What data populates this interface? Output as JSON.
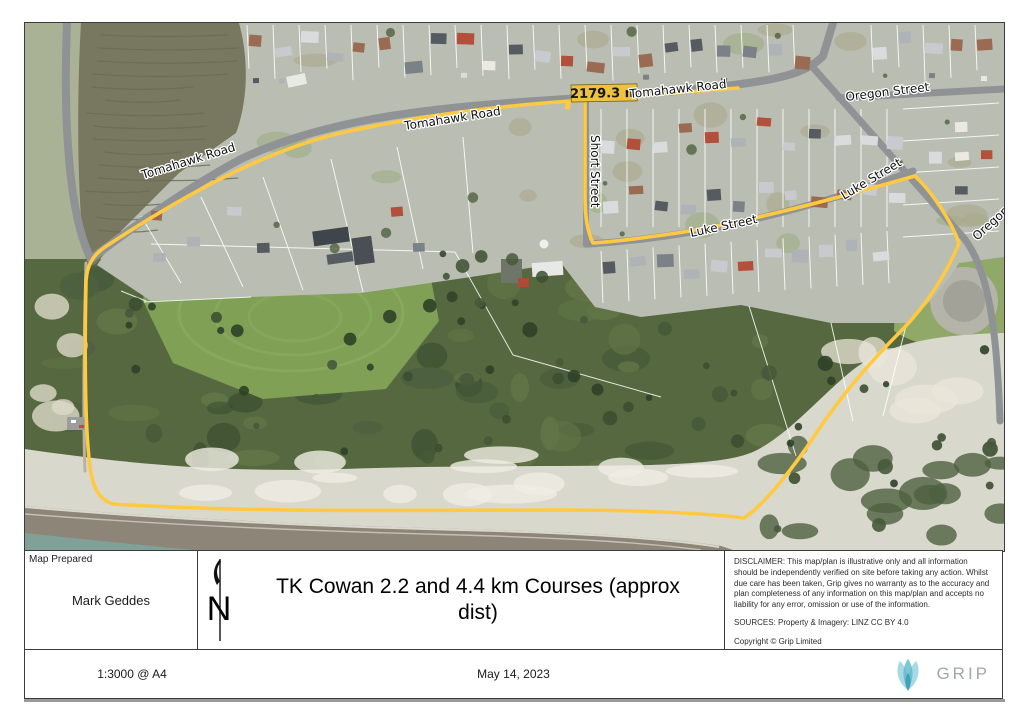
{
  "map": {
    "distance_label": "2179.3 m",
    "streets": {
      "tomahawk_road": "Tomahawk Road",
      "oregon_street": "Oregon Street",
      "short_street": "Short Street",
      "luke_street": "Luke Street"
    },
    "colors": {
      "route_yellow": "#ffc942",
      "distance_chip_gold": "#eec13e",
      "lagoon_olive": "#787860",
      "field_green": "#7fa055",
      "scrub_green": "#55683f",
      "sand": "#d9d8cd",
      "sea": "#8c8578",
      "road_grey": "#8f9396"
    }
  },
  "title_block": {
    "prepared_label": "Map Prepared",
    "prepared_by": "Mark Geddes",
    "north_letter": "N",
    "title": "TK Cowan 2.2 and 4.4 km Courses (approx dist)",
    "disclaimer": "DISCLAIMER: This map/plan is illustrative only and all information should be independently verified on site before taking any action. Whilst due care has been taken, Grip gives no warranty as to the accuracy and plan completeness of any information on this map/plan and accepts no liability for any error, omission or use of the information.",
    "sources": "SOURCES: Property & Imagery: LINZ CC BY 4.0",
    "copyright": "Copyright © Grip Limited"
  },
  "footer": {
    "scale": "1:3000 @ A4",
    "date": "May 14, 2023",
    "brand": "GRIP",
    "brand_teal": "#5cb8cc"
  }
}
